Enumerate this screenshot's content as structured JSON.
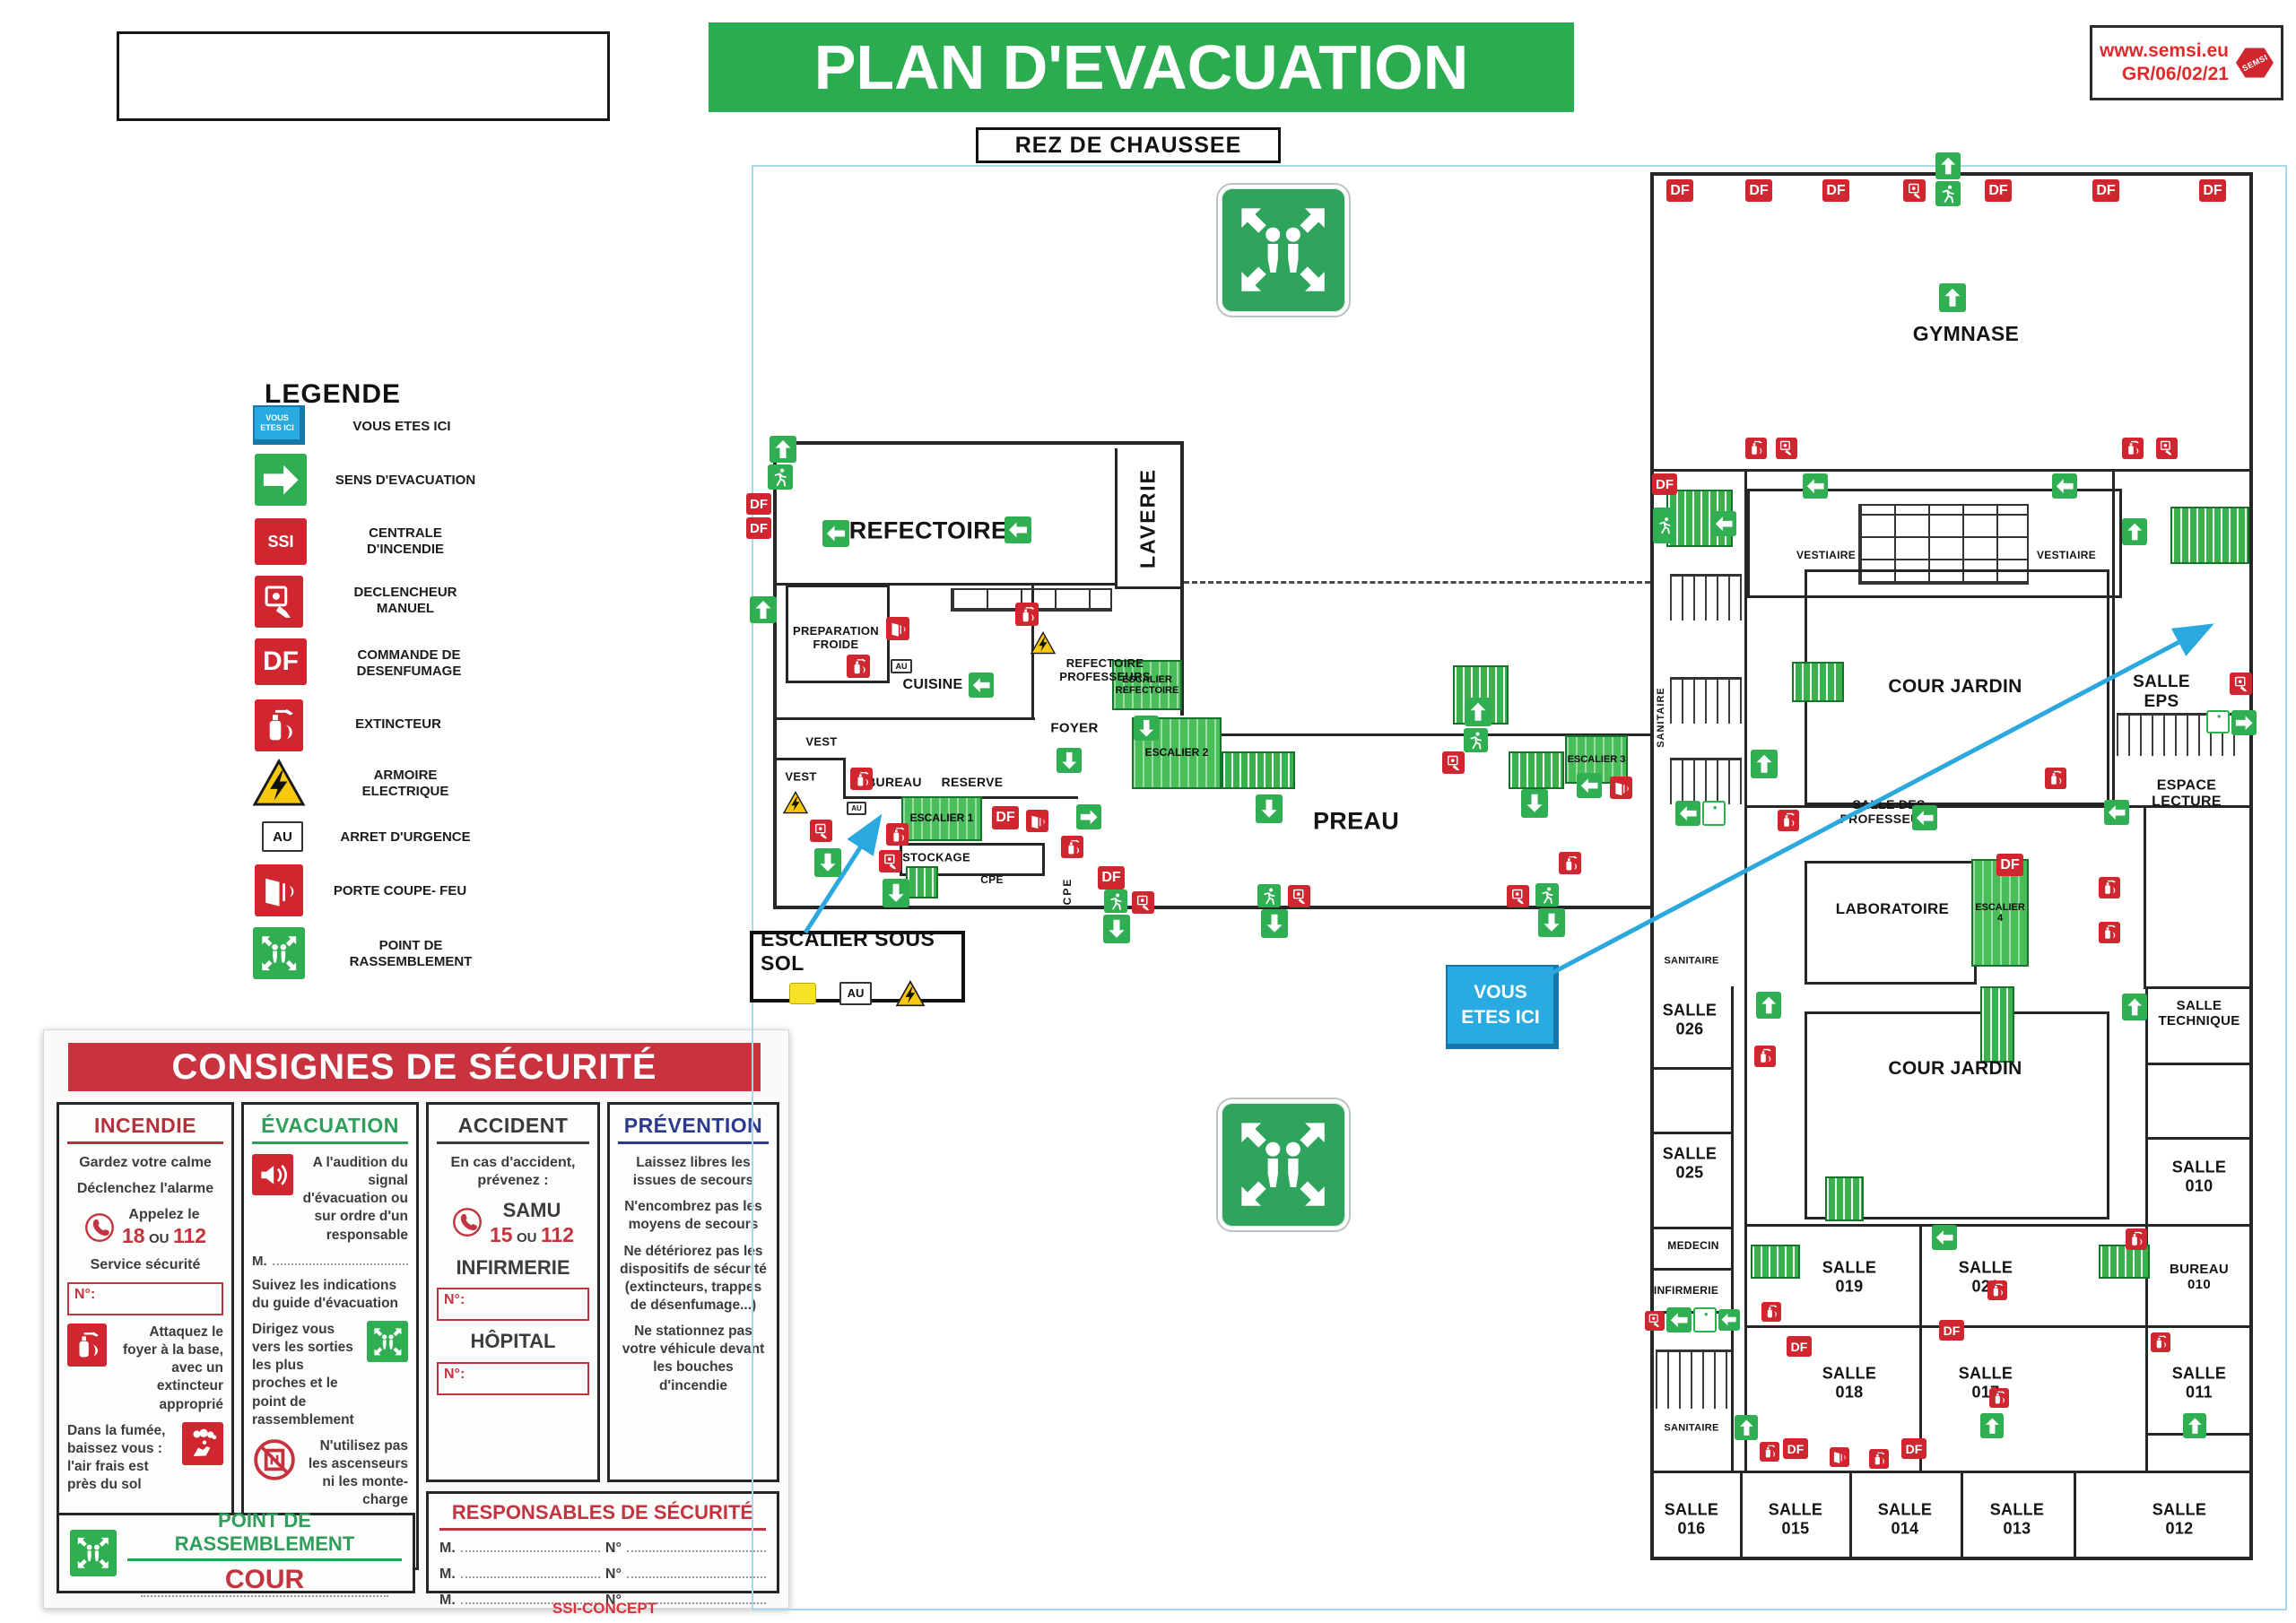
{
  "header": {
    "title": "PLAN D'EVACUATION",
    "floor": "REZ DE CHAUSSEE",
    "ref_site": "www.semsi.eu",
    "ref_code": "GR/06/02/21",
    "ref_logo": "SEMSI"
  },
  "symbols": {
    "df": "DF",
    "ssi": "SSI",
    "au": "AU"
  },
  "legend": {
    "title": "LEGENDE",
    "items": [
      {
        "icon": "you-are-here",
        "label": "VOUS ETES ICI"
      },
      {
        "icon": "evacuation-arrow",
        "label": "SENS D'EVACUATION"
      },
      {
        "icon": "fire-alarm-panel",
        "label": "CENTRALE D'INCENDIE"
      },
      {
        "icon": "manual-call-point",
        "label": "DECLENCHEUR MANUEL"
      },
      {
        "icon": "smoke-extraction-control",
        "label": "COMMANDE DE DESENFUMAGE"
      },
      {
        "icon": "extinguisher",
        "label": "EXTINCTEUR"
      },
      {
        "icon": "electrical-cabinet",
        "label": "ARMOIRE ELECTRIQUE"
      },
      {
        "icon": "emergency-stop",
        "label": "ARRET D'URGENCE"
      },
      {
        "icon": "fire-door",
        "label": "PORTE COUPE- FEU"
      },
      {
        "icon": "assembly-point",
        "label": "POINT DE RASSEMBLEMENT"
      }
    ]
  },
  "consignes": {
    "title": "CONSIGNES DE SÉCURITÉ",
    "incendie": {
      "title": "INCENDIE",
      "line1": "Gardez votre calme",
      "line2": "Déclenchez l'alarme",
      "call_prefix": "Appelez le",
      "n1": "18",
      "ou": "OU",
      "n2": "112",
      "service": "Service sécurité",
      "num_label": "N°:",
      "attack": "Attaquez le foyer à la base, avec un extincteur approprié",
      "smoke": "Dans la fumée, baissez vous : l'air frais est près du sol"
    },
    "evacuation": {
      "title": "ÉVACUATION",
      "signal": "A l'audition du signal d'évacuation ou sur ordre d'un responsable",
      "m_label": "M.",
      "follow": "Suivez les indications du guide d'évacuation",
      "direct": "Dirigez vous vers les sorties les plus proches et le point de rassemblement",
      "no_lift": "N'utilisez pas les ascenseurs ni les monte-charge"
    },
    "accident": {
      "title": "ACCIDENT",
      "intro": "En cas d'accident, prévenez :",
      "samu": "SAMU",
      "n1": "15",
      "ou": "OU",
      "n2": "112",
      "infirmerie": "INFIRMERIE",
      "num_label": "N°:",
      "hopital": "HÔPITAL"
    },
    "prevention": {
      "title": "PRÉVENTION",
      "p1": "Laissez libres les issues de secours",
      "p2": "N'encombrez pas les moyens de secours",
      "p3": "Ne détériorez pas les dispositifs de sécurité (extincteurs, trappes de désenfumage...)",
      "p4": "Ne stationnez pas votre véhicule devant les bouches d'incendie"
    },
    "responsables": {
      "title": "RESPONSABLES DE SÉCURITÉ",
      "m_label": "M.",
      "n_label": "N°"
    },
    "rassemblement": {
      "title": "POINT DE RASSEMBLEMENT",
      "location": "COUR"
    },
    "footer_brand": "SSI-CONCEPT",
    "footer_url": "www.ssi-concept.com"
  },
  "plan": {
    "you_are_here": "VOUS ETES ICI",
    "callout_sous_sol": "ESCALIER SOUS SOL",
    "rooms": {
      "refectoire": "REFECTOIRE",
      "laverie": "LAVERIE",
      "preparation_froide": "PREPARATION FROIDE",
      "cuisine": "CUISINE",
      "refectoire_professeurs": "REFECTOIRE PROFESSEURS",
      "escalier_refectoire": "ESCALIER REFECTOIRE",
      "foyer": "FOYER",
      "vest_1": "VEST",
      "vest_2": "VEST",
      "bureau": "BUREAU",
      "reserve": "RESERVE",
      "escalier_1": "ESCALIER 1",
      "stockage": "STOCKAGE",
      "cpe_1": "CPE",
      "cpe_2": "CPE",
      "preau": "PREAU",
      "escalier_2": "ESCALIER 2",
      "escalier_3": "ESCALIER 3",
      "gymnase": "GYMNASE",
      "vestiaire_1": "VESTIAIRE",
      "vestiaire_2": "VESTIAIRE",
      "cour_jardin_1": "COUR JARDIN",
      "salle_eps": "SALLE EPS",
      "sanitaire_1": "SANITAIRE",
      "salle_des_professeurs": "SALLE DES PROFESSEURS",
      "espace_lecture": "ESPACE LECTURE",
      "laboratoire": "LABORATOIRE",
      "escalier_4": "ESCALIER 4",
      "sanitaire_2": "SANITAIRE",
      "salle_026": "SALLE 026",
      "salle_025": "SALLE 025",
      "medecin": "MEDECIN",
      "infirmerie": "INFIRMERIE",
      "cour_jardin_2": "COUR JARDIN",
      "salle_technique": "SALLE TECHNIQUE",
      "salle_010": "SALLE 010",
      "salle_019": "SALLE 019",
      "salle_021": "SALLE 021",
      "bureau_010": "BUREAU 010",
      "salle_018": "SALLE 018",
      "salle_017": "SALLE 017",
      "salle_011": "SALLE 011",
      "sanitaire_3": "SANITAIRE",
      "salle_016": "SALLE 016",
      "salle_015": "SALLE 015",
      "salle_014": "SALLE 014",
      "salle_013": "SALLE 013",
      "salle_012": "SALLE 012"
    }
  }
}
